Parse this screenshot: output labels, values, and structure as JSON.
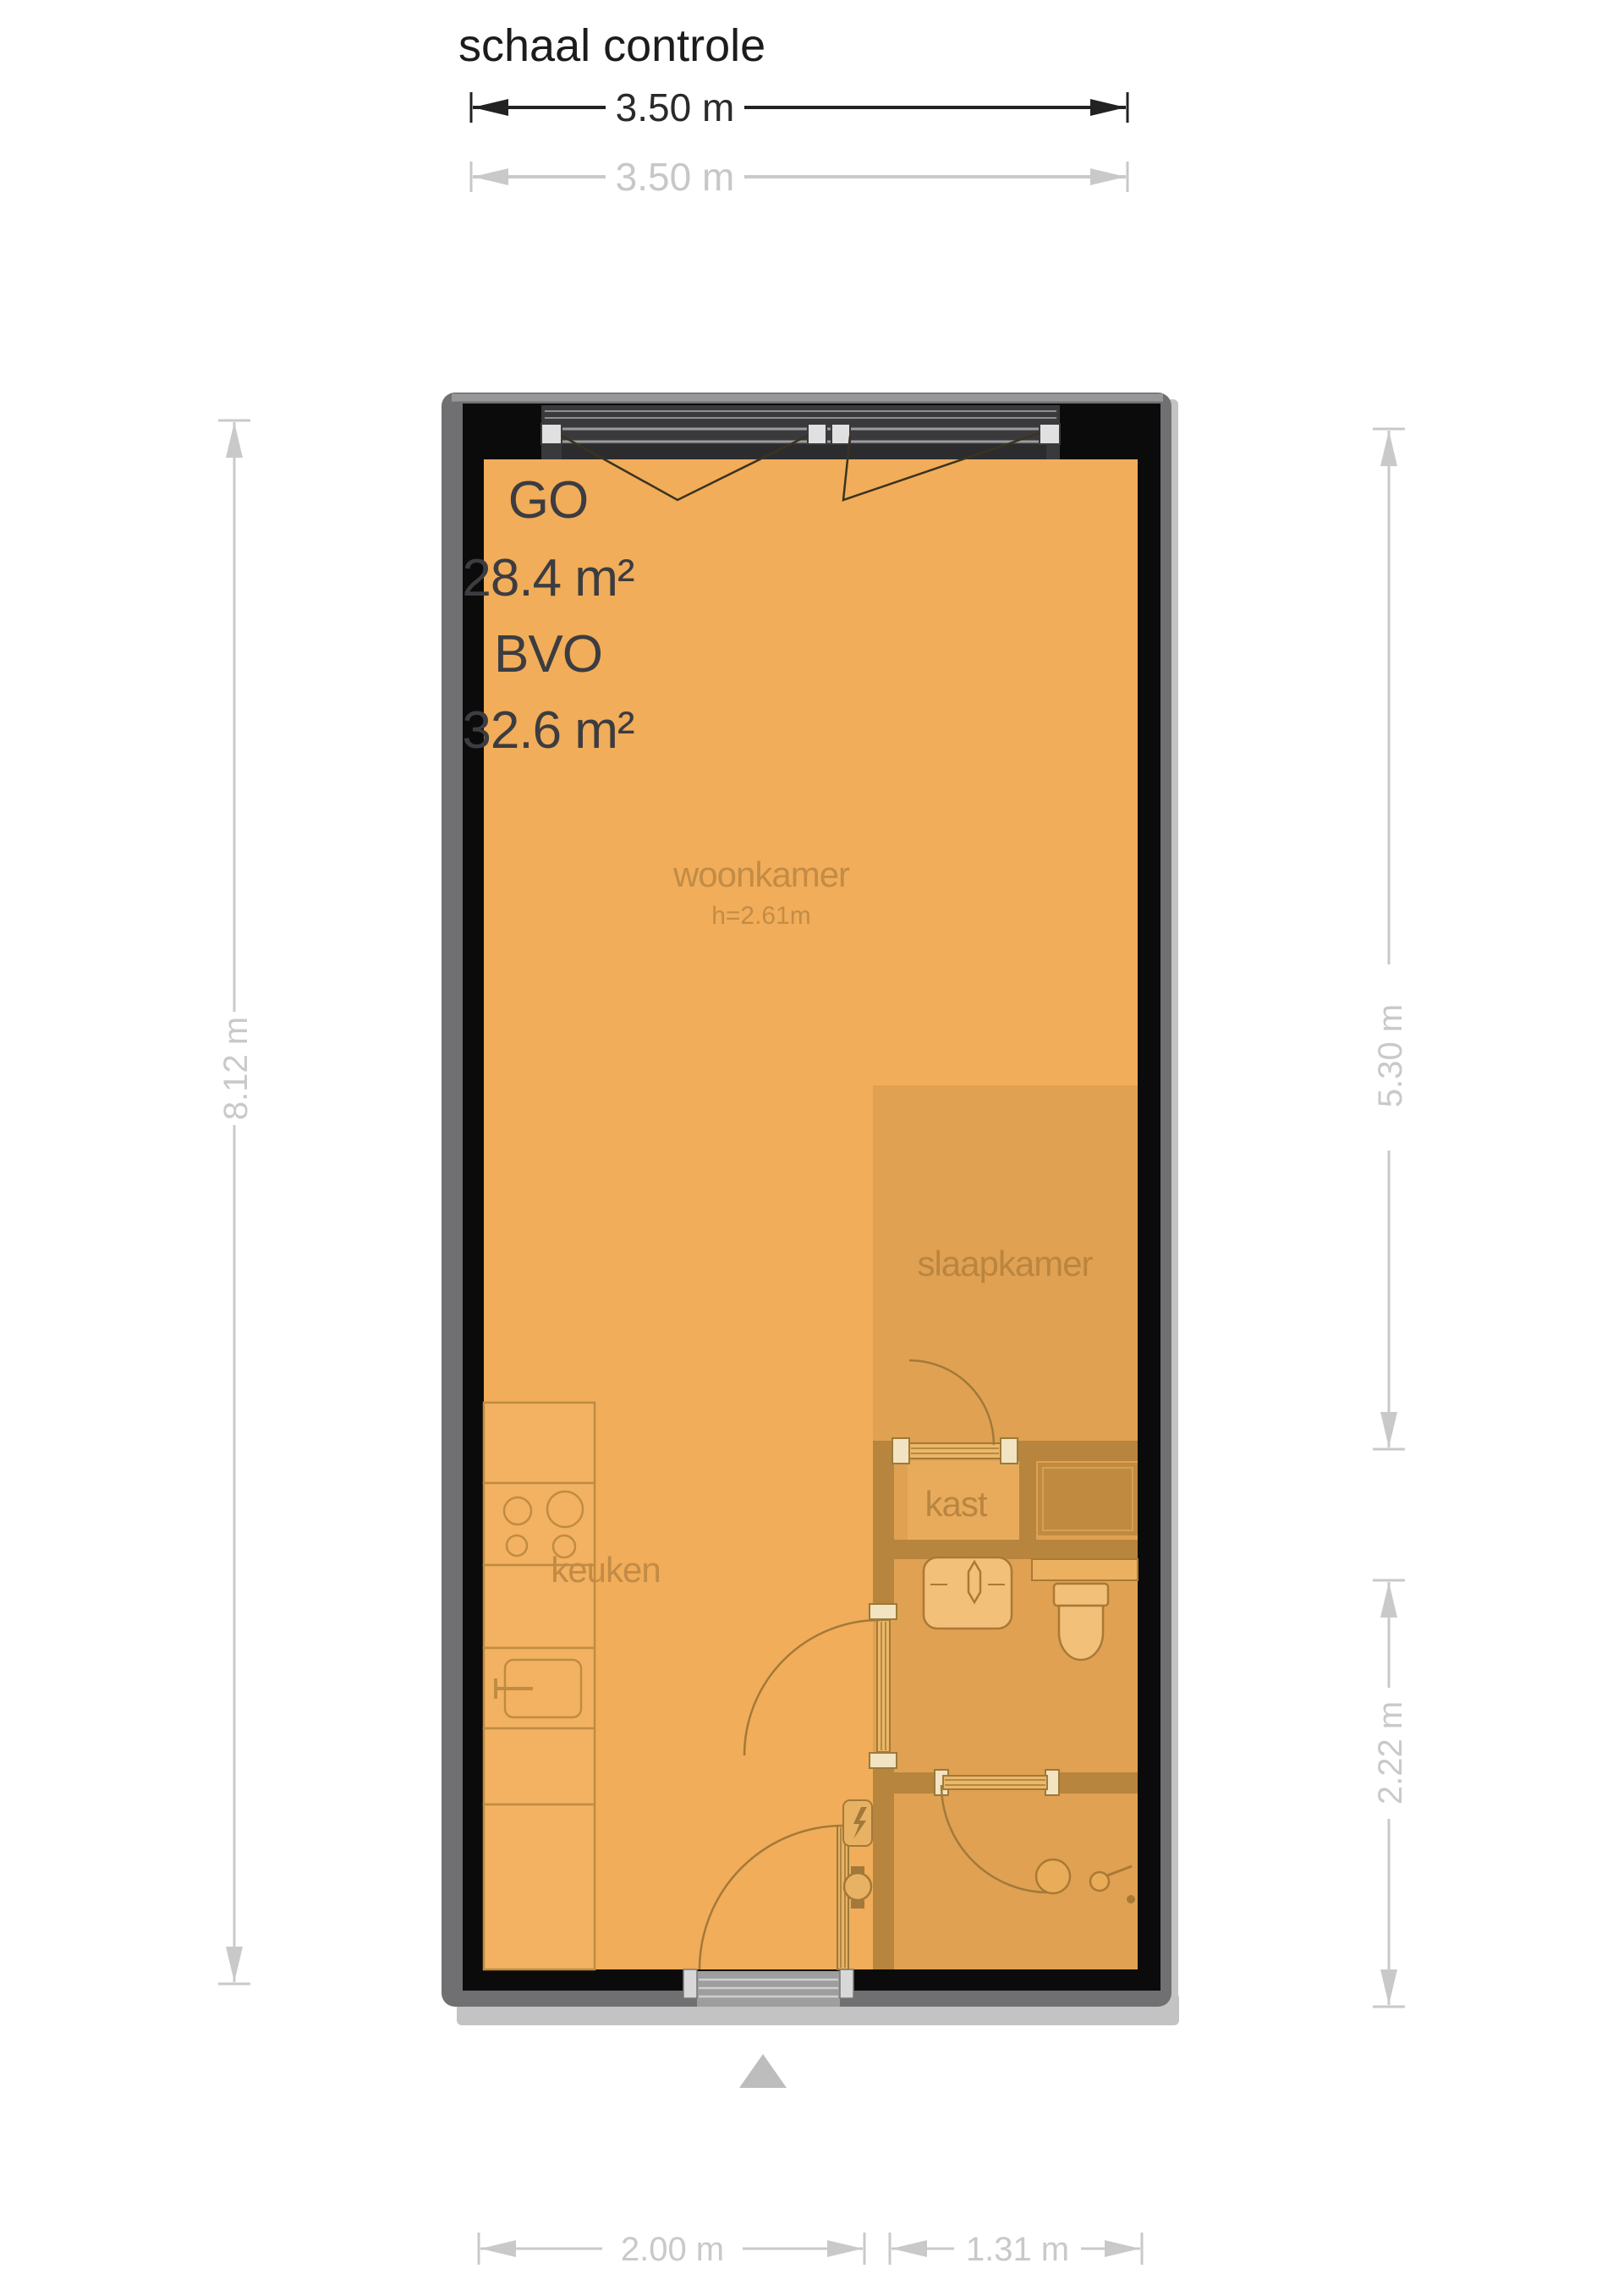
{
  "title": "schaal controle",
  "scale_check": {
    "primary_label": "3.50 m",
    "secondary_label": "3.50 m"
  },
  "area_summary": {
    "go_label": "GO",
    "go_value": "28.4 m²",
    "bvo_label": "BVO",
    "bvo_value": "32.6 m²"
  },
  "rooms": {
    "living": {
      "name": "woonkamer",
      "ceiling_height": "h=2.61m"
    },
    "bedroom": {
      "name": "slaapkamer"
    },
    "closet": {
      "name": "kast"
    },
    "kitchen": {
      "name": "keuken"
    }
  },
  "dimensions": {
    "left": "8.12 m",
    "right_upper": "5.30 m",
    "right_lower": "2.22 m",
    "bottom_left": "2.00 m",
    "bottom_right": "1.31 m"
  },
  "icons": {
    "entrance_arrow": "entrance-direction-triangle",
    "window": "top-casement-window",
    "stove": "four-burner-stove",
    "kitchen_sink": "kitchen-sink-with-faucet",
    "washbasin": "bathroom-washbasin",
    "toilet": "toilet",
    "shower_drain": "shower-drain",
    "shower_head": "shower-head",
    "electric_meter": "electric-meter",
    "water_meter": "water-meter"
  },
  "colors": {
    "floor": "#f1ad59",
    "overlay_tint": "rgba(107,74,30,0.12)",
    "outer_wall": "#0b0b0b",
    "wall_outline": "#707073",
    "wall_shadow": "#c3c3c3",
    "interior_wall": "#b7853d",
    "fixture_stroke": "#a97a36",
    "fixture_fill": "#f3c07a",
    "room_label": "#c28c46",
    "dimension_gray": "#c9c9c9",
    "scale_black": "#222222"
  }
}
